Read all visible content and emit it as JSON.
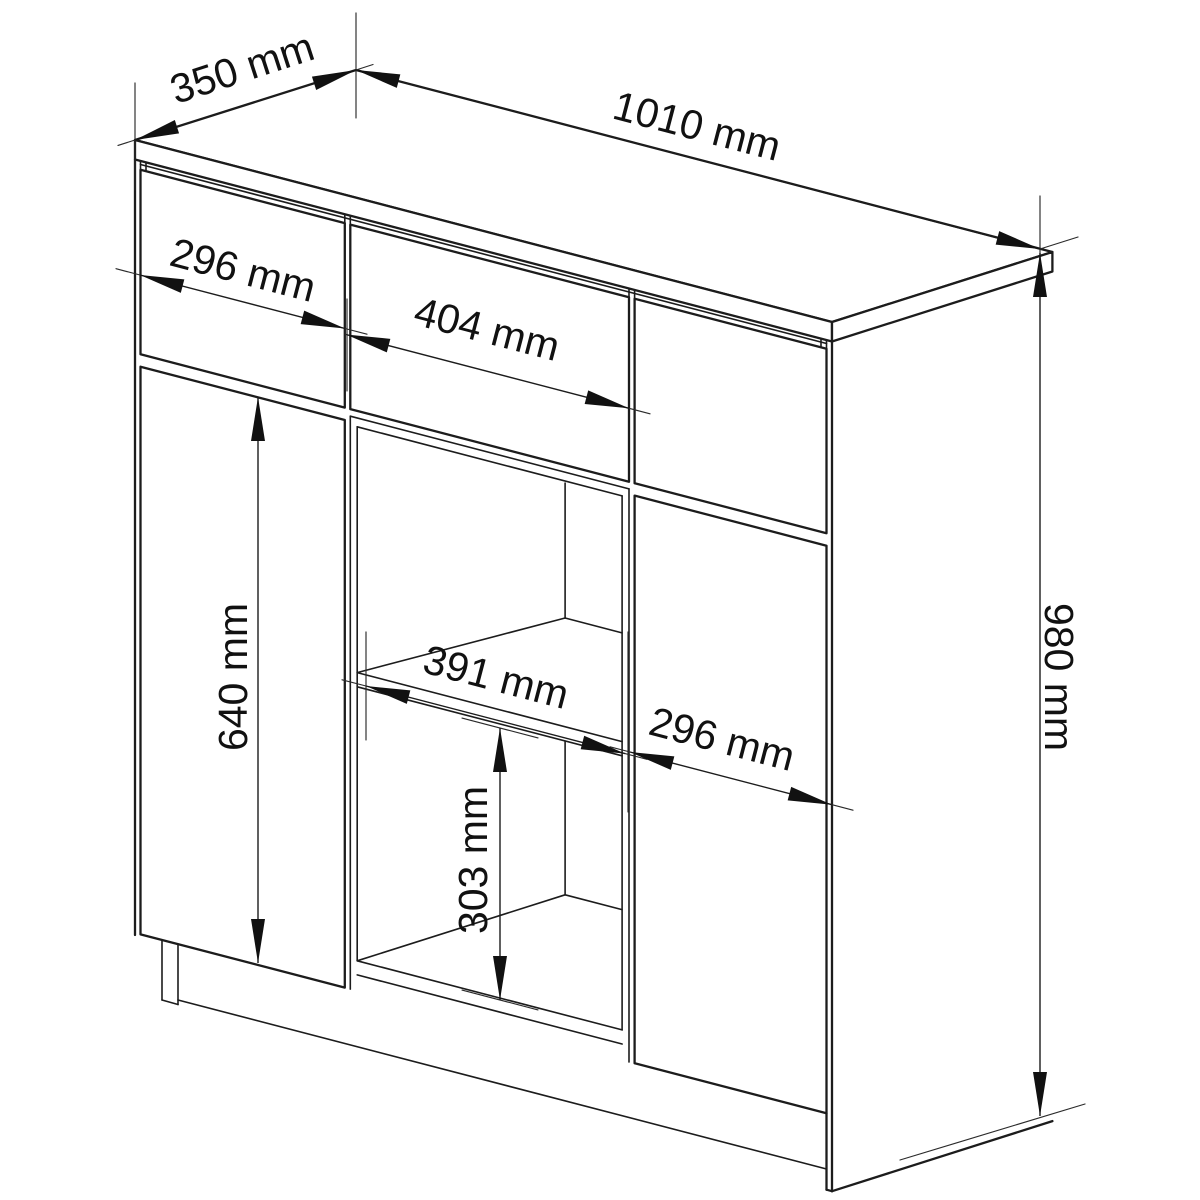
{
  "diagram": {
    "kind": "furniture technical drawing",
    "subject": "sideboard cabinet with drawers, doors and open shelf",
    "unit": "mm",
    "background_color": "#ffffff",
    "line_color": "#1c1c1c",
    "labels": {
      "depth": "350 mm",
      "width": "1010 mm",
      "height": "980 mm",
      "left_drawer_width": "296 mm",
      "middle_drawer_width": "404 mm",
      "left_door_height": "640 mm",
      "shelf_inner_width": "391 mm",
      "lower_compartment_height": "303 mm",
      "right_door_width": "296 mm"
    },
    "values_mm": {
      "depth": 350,
      "width": 1010,
      "height": 980,
      "left_drawer_width": 296,
      "middle_drawer_width": 404,
      "left_door_height": 640,
      "shelf_inner_width": 391,
      "lower_compartment_height": 303,
      "right_door_width": 296
    }
  }
}
